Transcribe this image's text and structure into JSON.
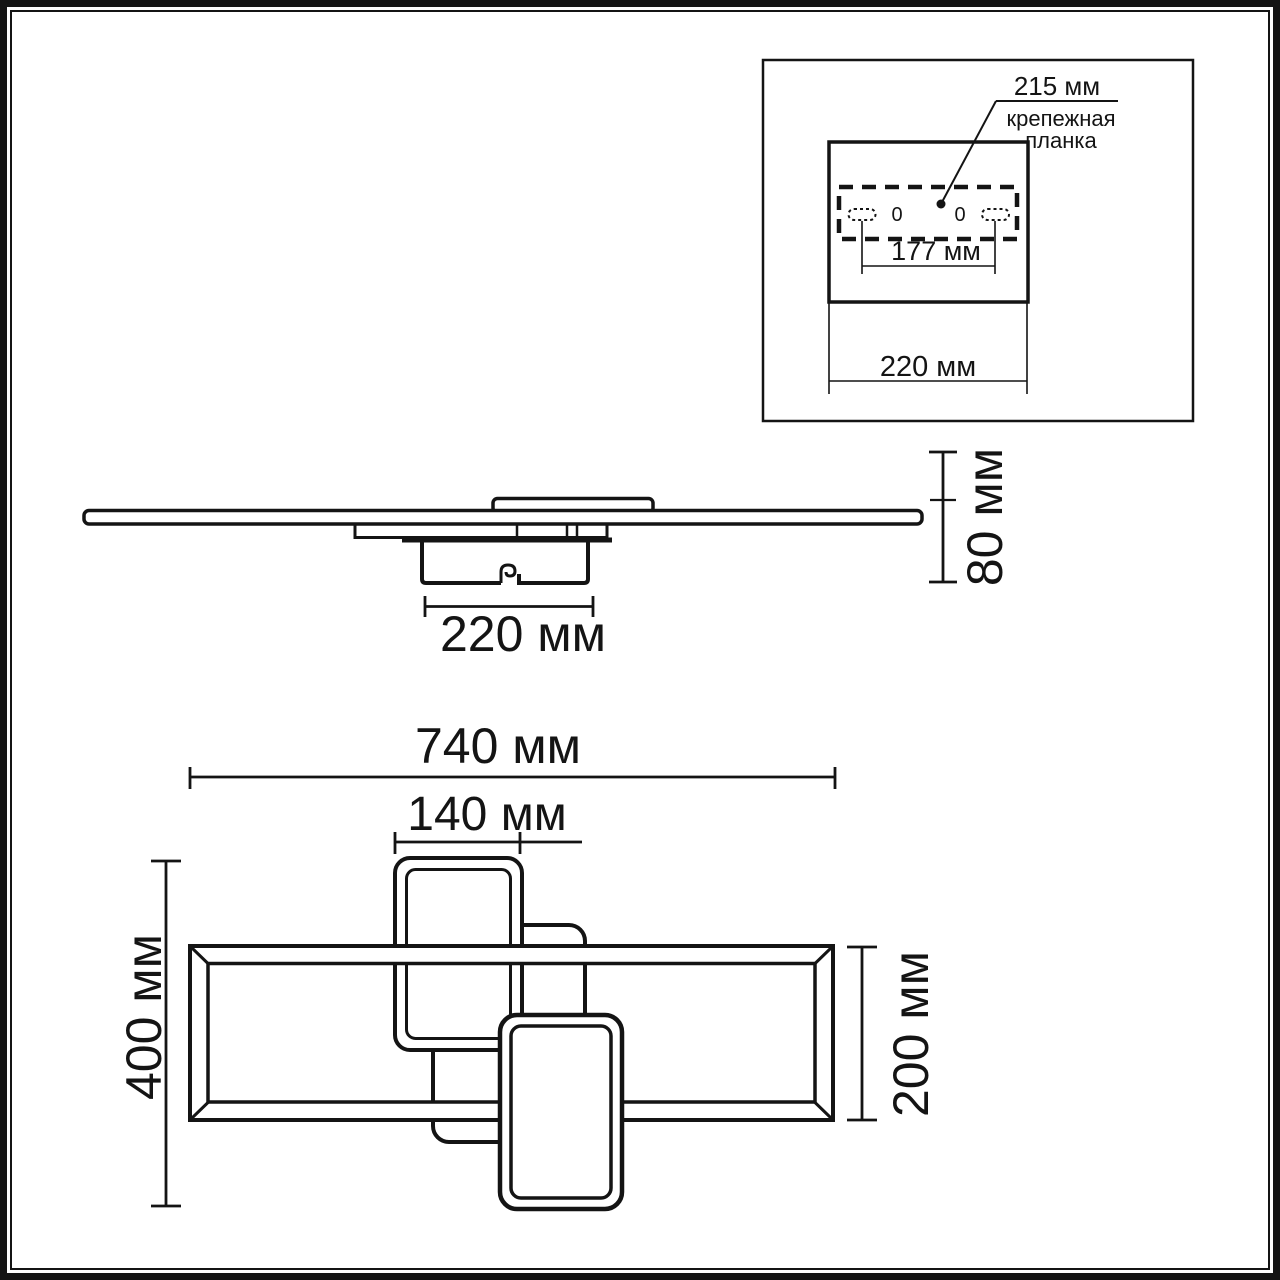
{
  "page": {
    "line_color": "#141414",
    "background": "#ffffff"
  },
  "inset": {
    "plate_width_label": "215 мм",
    "part_label_line1": "крепежная",
    "part_label_line2": "планка",
    "hole_spacing_label": "177 мм",
    "canopy_width_label": "220 мм",
    "hole_left_label": "0",
    "hole_right_label": "0"
  },
  "side_view": {
    "canopy_width_label": "220 мм",
    "height_label": "80 мм"
  },
  "top_view": {
    "overall_width_label": "740 мм",
    "small_ring_width_label": "140 мм",
    "overall_height_label": "400 мм",
    "frame_height_label": "200 мм"
  }
}
